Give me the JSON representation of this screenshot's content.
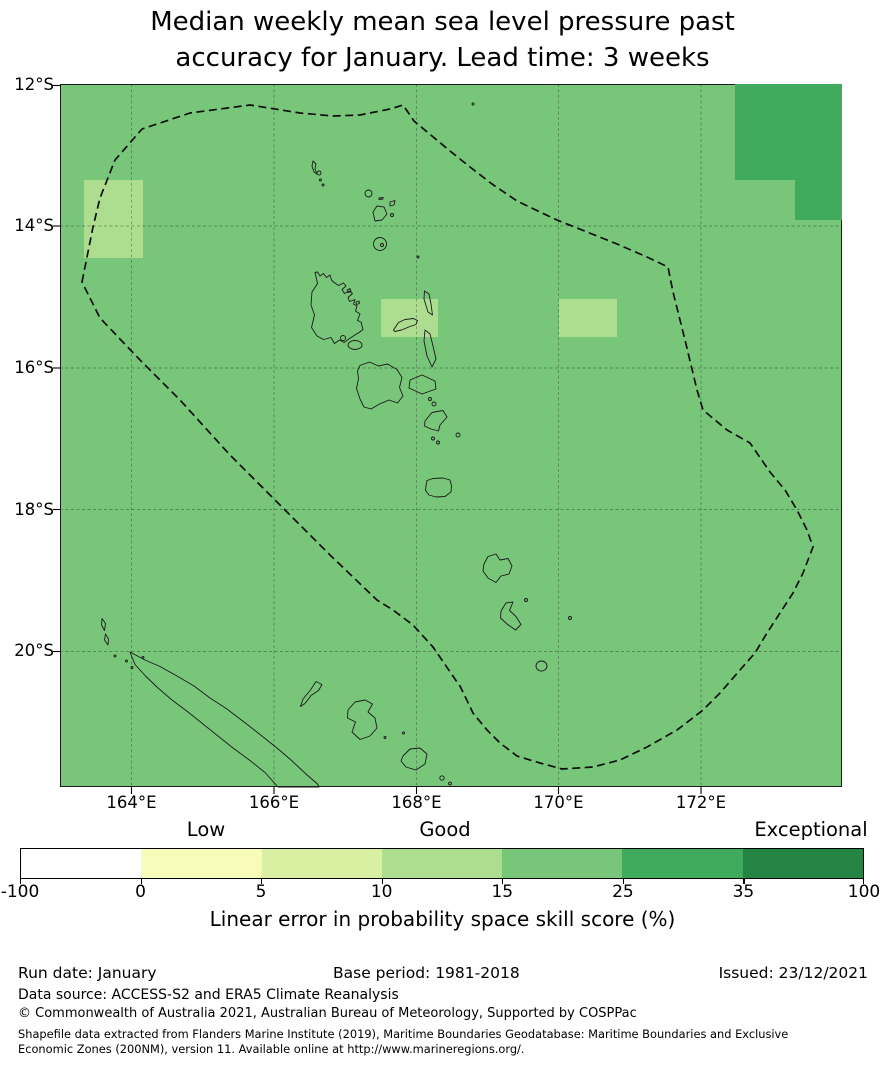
{
  "palette": [
    "#ffffff",
    "#f7fcb9",
    "#d9f0a3",
    "#addd8e",
    "#78c679",
    "#41ab5d",
    "#238443"
  ],
  "title": {
    "line1": "Median weekly mean sea level pressure past",
    "line2": "accuracy for January. Lead time: 3 weeks"
  },
  "map": {
    "y_ticks": [
      "12°S",
      "14°S",
      "16°S",
      "18°S",
      "20°S"
    ],
    "x_ticks": [
      "164°E",
      "166°E",
      "168°E",
      "170°E",
      "172°E"
    ]
  },
  "colorbar": {
    "quality_labels": [
      "Low",
      "Good",
      "Exceptional"
    ],
    "ticks": [
      "-100",
      "0",
      "5",
      "10",
      "15",
      "25",
      "35",
      "100"
    ],
    "axis_label": "Linear error in probability space skill score (%)"
  },
  "footer": {
    "run_date": "Run date: January",
    "base_period": "Base period: 1981-2018",
    "issued": "Issued: 23/12/2021",
    "data_source": "Data source: ACCESS-S2 and ERA5 Climate Reanalysis",
    "copyright": "© Commonwealth of Australia 2021, Australian Bureau of Meteorology, Supported by COSPPac",
    "shapefile_line1": "Shapefile data extracted from Flanders Marine Institute (2019), Maritime Boundaries Geodatabase: Maritime Boundaries and Exclusive",
    "shapefile_line2": "Economic Zones (200NM), version 11. Available online at http://www.marineregions.org/."
  },
  "chart_data": {
    "type": "heatmap",
    "title": "Median weekly mean sea level pressure past accuracy for January. Lead time: 3 weeks",
    "region": "Vanuatu and surrounding EEZ (New Caledonia to Banks/Torres Islands)",
    "x_axis": {
      "label": "Longitude",
      "ticks": [
        "164°E",
        "166°E",
        "168°E",
        "170°E",
        "172°E"
      ],
      "range": [
        "163°E",
        "174°E"
      ]
    },
    "y_axis": {
      "label": "Latitude",
      "ticks": [
        "12°S",
        "14°S",
        "16°S",
        "18°S",
        "20°S"
      ],
      "range": [
        "12°S",
        "21.9°S"
      ]
    },
    "colorbar": {
      "label": "Linear error in probability space skill score (%)",
      "bounds": [
        -100,
        0,
        5,
        10,
        15,
        25,
        35,
        100
      ],
      "colors": [
        "#ffffff",
        "#f7fcb9",
        "#d9f0a3",
        "#addd8e",
        "#78c679",
        "#41ab5d",
        "#238443"
      ],
      "qualitative_labels": [
        {
          "text": "Low",
          "over_bin": "0 to 5"
        },
        {
          "text": "Good",
          "over_bin": "10 to 15"
        },
        {
          "text": "Exceptional",
          "over_bin": "35 to 100"
        }
      ]
    },
    "cells": [
      {
        "area": "background (most of map)",
        "skill_bin": "15 to 25",
        "color": "#78c679"
      },
      {
        "area": "~163.3-164.2°E, 13.3-14.4°S (west, near EEZ edge)",
        "skill_bin": "10 to 15",
        "color": "#addd8e"
      },
      {
        "area": "~167.5-168.3°E, 15.0-15.6°S (over Ambae)",
        "skill_bin": "10 to 15",
        "color": "#addd8e"
      },
      {
        "area": "~170.0-170.8°E, 15.0-15.6°S",
        "skill_bin": "10 to 15",
        "color": "#addd8e"
      },
      {
        "area": "northeast corner ~172.5-174°E, 12-13.4°S (L-shaped)",
        "skill_bin": "25 to 35",
        "color": "#41ab5d"
      }
    ],
    "overlays": [
      "dashed EEZ boundary polygon",
      "island coastlines (Vanuatu chain, Banks Islands, New Caledonia, Loyalty Islands)",
      "2-degree lat/lon grid"
    ],
    "footer": {
      "run_date": "January",
      "base_period": "1981-2018",
      "issued": "23/12/2021",
      "data_source": "ACCESS-S2 and ERA5 Climate Reanalysis"
    }
  }
}
